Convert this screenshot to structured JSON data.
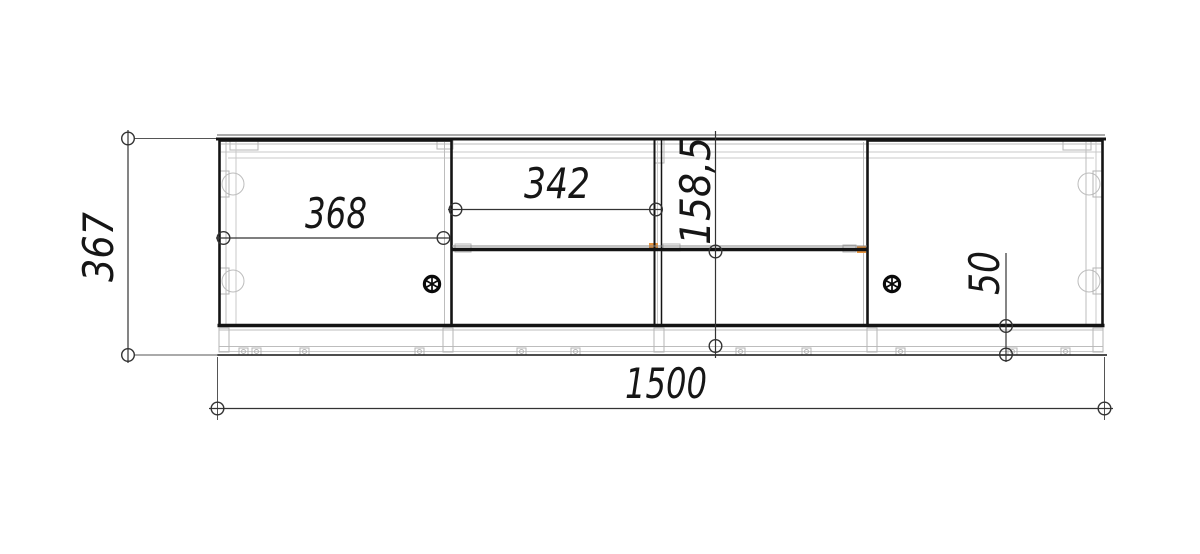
{
  "drawing": {
    "title": "cabinet-front-elevation",
    "background_color": "#ffffff",
    "line_color": "#141414",
    "construction_color": "#bdbdbd",
    "dimension_color": "#333333",
    "highlight_color": "#e8953f",
    "dimensions": {
      "overall_width": "1500",
      "overall_height": "367",
      "left_door_width": "368",
      "middle_niche_width": "342",
      "niche_height": "158,5",
      "plinth_height": "50"
    }
  }
}
